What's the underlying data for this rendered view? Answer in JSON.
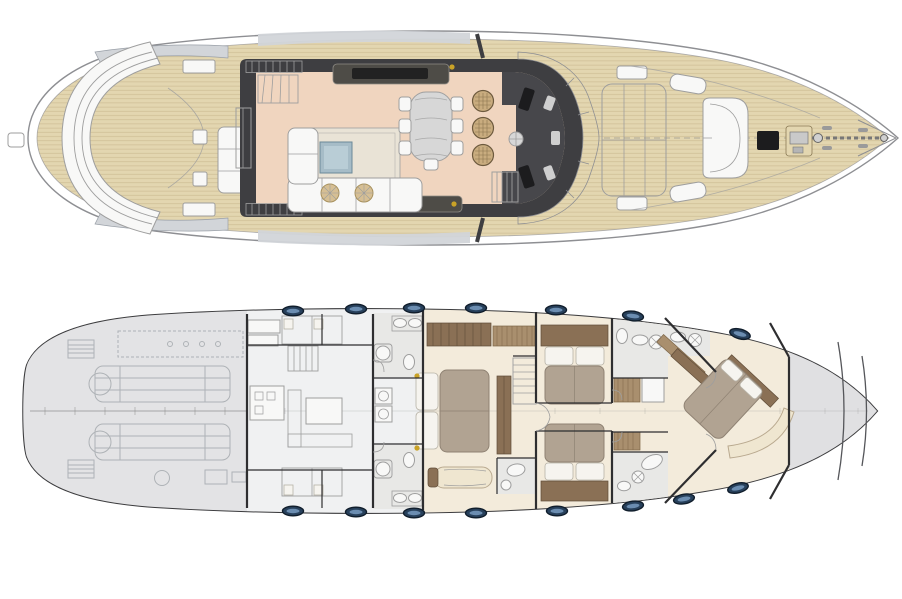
{
  "image": {
    "kind": "yacht-general-arrangement-plan",
    "views": 2,
    "width_px": 902,
    "height_px": 599
  },
  "colors": {
    "background": "#ffffff",
    "hull_line": "#8e8f93",
    "hull_line_dark": "#3c3c3e",
    "wall": "#2e2e30",
    "teak": "#e3d6b0",
    "teak_line": "#b7a378",
    "deckhouse": "#3e3e41",
    "salon_floor": "#f0d5bf",
    "galley": "#47474b",
    "furniture_white": "#f8f8f7",
    "furniture_line": "#9e9e9e",
    "rug": "#e9e3d6",
    "coffee_table": "#a6bcc7",
    "pouf_tan": "#d6bf94",
    "wicker_tan": "#c9ac7f",
    "table_silver": "#d7d7d7",
    "hardtop_gray": "#d2d5d9",
    "windshield_gray": "#eef0f1",
    "gold": "#c9a227",
    "engine_room_gray": "#e3e3e5",
    "engine_line_gray": "#aeb2b6",
    "crew_floor": "#f0f1f2",
    "tile_gray": "#e8e8e6",
    "cabin_cream": "#f3ebdb",
    "bed_taupe": "#b1a392",
    "pillow_white": "#f6f4ef",
    "wood_brown": "#8a7055",
    "wood_slat": "#a98f6e",
    "settee_cream": "#efe6d0",
    "bow_gray": "#e0e0e2",
    "porthole_navy": "#27405b",
    "porthole_ring": "#101d2b",
    "porthole_glass": "#7396ba",
    "centerline_gray": "#8b8b8b",
    "black_hatch": "#1c1c1e"
  },
  "decks": [
    {
      "id": "main-deck",
      "features": [
        "swim-ladder",
        "teak-aft-deck",
        "crescent-transom-seat",
        "aft-deck-table",
        "side-boarding-steps",
        "hardtop-edge",
        "deckhouse",
        "sliding-door",
        "flybridge-stairs",
        "salon",
        "salon-sofa",
        "salon-rug",
        "coffee-table",
        "poufs",
        "tv-console",
        "sideboard",
        "dining-table",
        "dining-chairs",
        "bar-stools",
        "galley",
        "stairs-to-lower-deck",
        "windshield",
        "foredeck-sunpad",
        "bow-dinette-seat",
        "deck-boxes",
        "deck-hatch",
        "anchor-windlass",
        "anchor-chain",
        "bow-pulpit"
      ]
    },
    {
      "id": "lower-deck",
      "features": [
        "engine-room",
        "twin-engines",
        "generator",
        "crew-quarters",
        "crew-bunks",
        "crew-stairs",
        "crew-mess",
        "bathroom-port",
        "bathroom-starboard",
        "laundry",
        "master-cabin",
        "master-bed",
        "master-wardrobe",
        "tv-cabinet",
        "master-stairs",
        "master-bench",
        "master-bathroom",
        "corridor",
        "guest-cabin-top",
        "guest-cabin-bottom",
        "guest-beds",
        "guest-bathrooms",
        "closets",
        "vip-cabin",
        "vip-bed",
        "vip-wardrobe",
        "vip-settee",
        "bow-storage",
        "portholes"
      ]
    }
  ],
  "portholes": {
    "top_count": 7,
    "bottom_count": 8
  }
}
